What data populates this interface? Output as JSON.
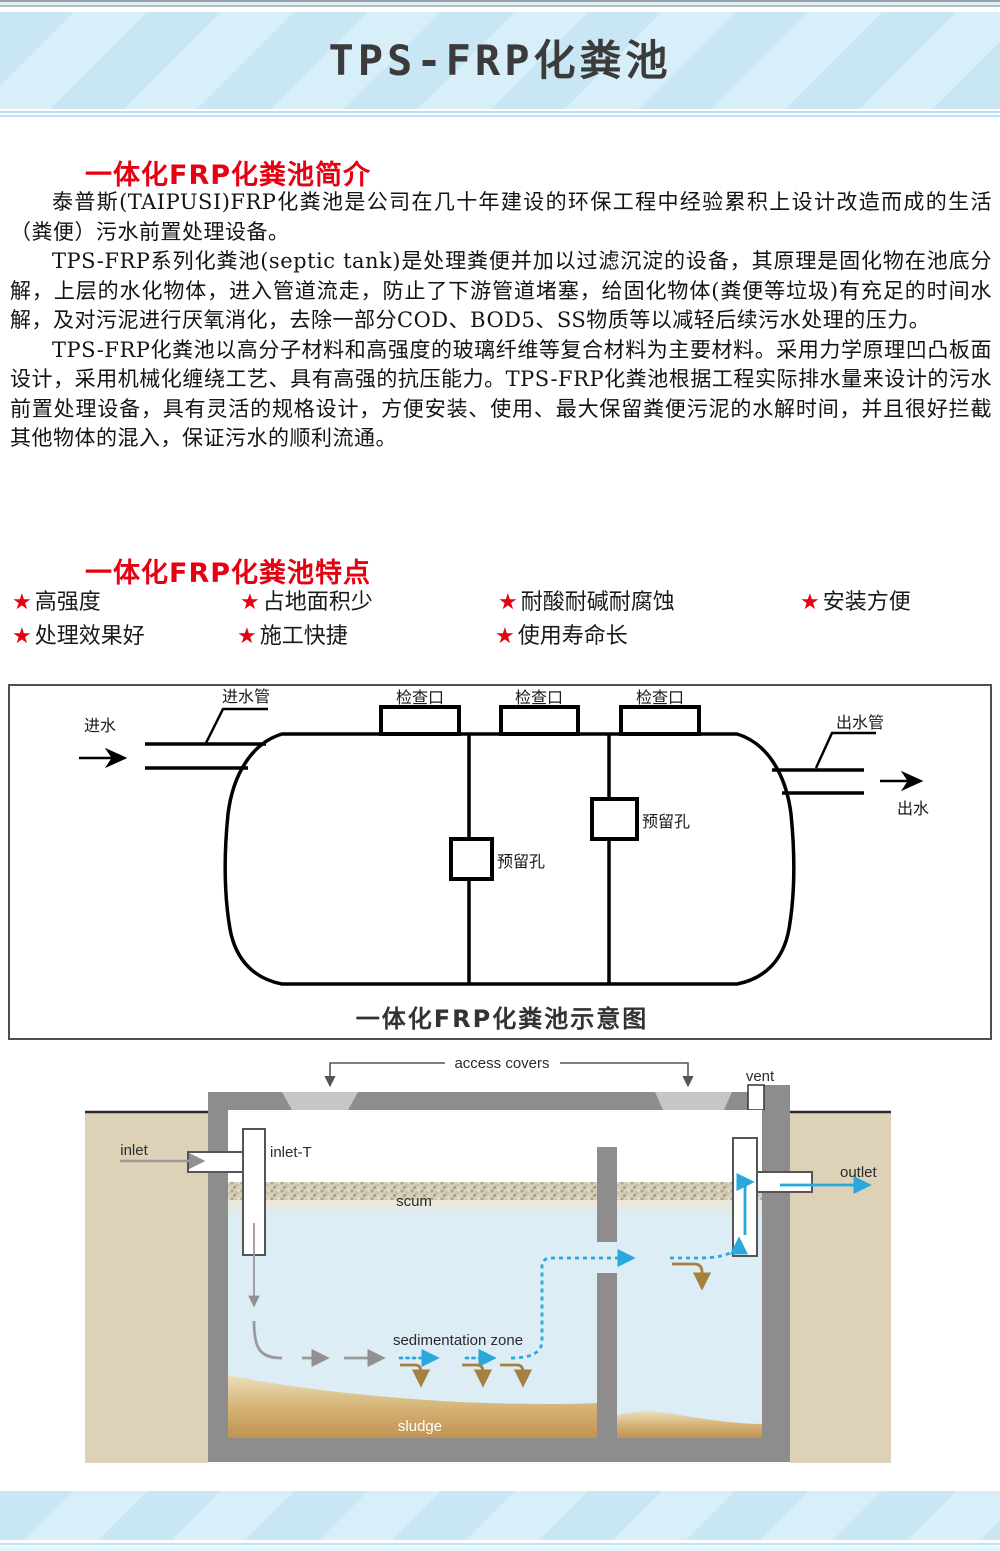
{
  "header": {
    "title": "TPS-FRP化粪池"
  },
  "intro": {
    "heading": "一体化FRP化粪池简介",
    "paragraphs": [
      "泰普斯(TAIPUSI)FRP化粪池是公司在几十年建设的环保工程中经验累积上设计改造而成的生活（粪便）污水前置处理设备。",
      "TPS-FRP系列化粪池(septic tank)是处理粪便并加以过滤沉淀的设备，其原理是固化物在池底分解，上层的水化物体，进入管道流走，防止了下游管道堵塞，给固化物体(粪便等垃圾)有充足的时间水解，及对污泥进行厌氧消化，去除一部分COD、BOD5、SS物质等以减轻后续污水处理的压力。",
      "TPS-FRP化粪池以高分子材料和高强度的玻璃纤维等复合材料为主要材料。采用力学原理凹凸板面设计，采用机械化缠绕工艺、具有高强的抗压能力。TPS-FRP化粪池根据工程实际排水量来设计的污水前置处理设备，具有灵活的规格设计，方便安装、使用、最大保留粪便污泥的水解时间，并且很好拦截其他物体的混入，保证污水的顺利流通。"
    ]
  },
  "features": {
    "heading": "一体化FRP化粪池特点",
    "star": "★",
    "items": [
      "高强度",
      "占地面积少",
      "耐酸耐碱耐腐蚀",
      "安装方便",
      "处理效果好",
      "施工快捷",
      "使用寿命长"
    ]
  },
  "diagram": {
    "caption": "一体化FRP化粪池示意图",
    "labels": {
      "inlet_pipe": "进水管",
      "inlet": "进水",
      "inspection_port": "检查口",
      "outlet_pipe": "出水管",
      "outlet": "出水",
      "reserved_hole": "预留孔"
    }
  },
  "cross_section": {
    "labels": {
      "access_covers": "access covers",
      "vent": "vent",
      "inlet": "inlet",
      "inlet_t": "inlet-T",
      "scum": "scum",
      "outlet": "outlet",
      "sedimentation_zone": "sedimentation zone",
      "sludge": "sludge"
    }
  },
  "colors": {
    "accent_red": "#e60012",
    "band_blue": "#c9e6f4",
    "band_stripe": "#d8eef9",
    "water_blue": "#dcedf5",
    "ground_tan": "#ddd2b8",
    "wall_gray": "#8d8d8d",
    "flow_blue": "#29a8dc",
    "flow_brown": "#a5803f",
    "sludge_brown": "#c09250"
  }
}
